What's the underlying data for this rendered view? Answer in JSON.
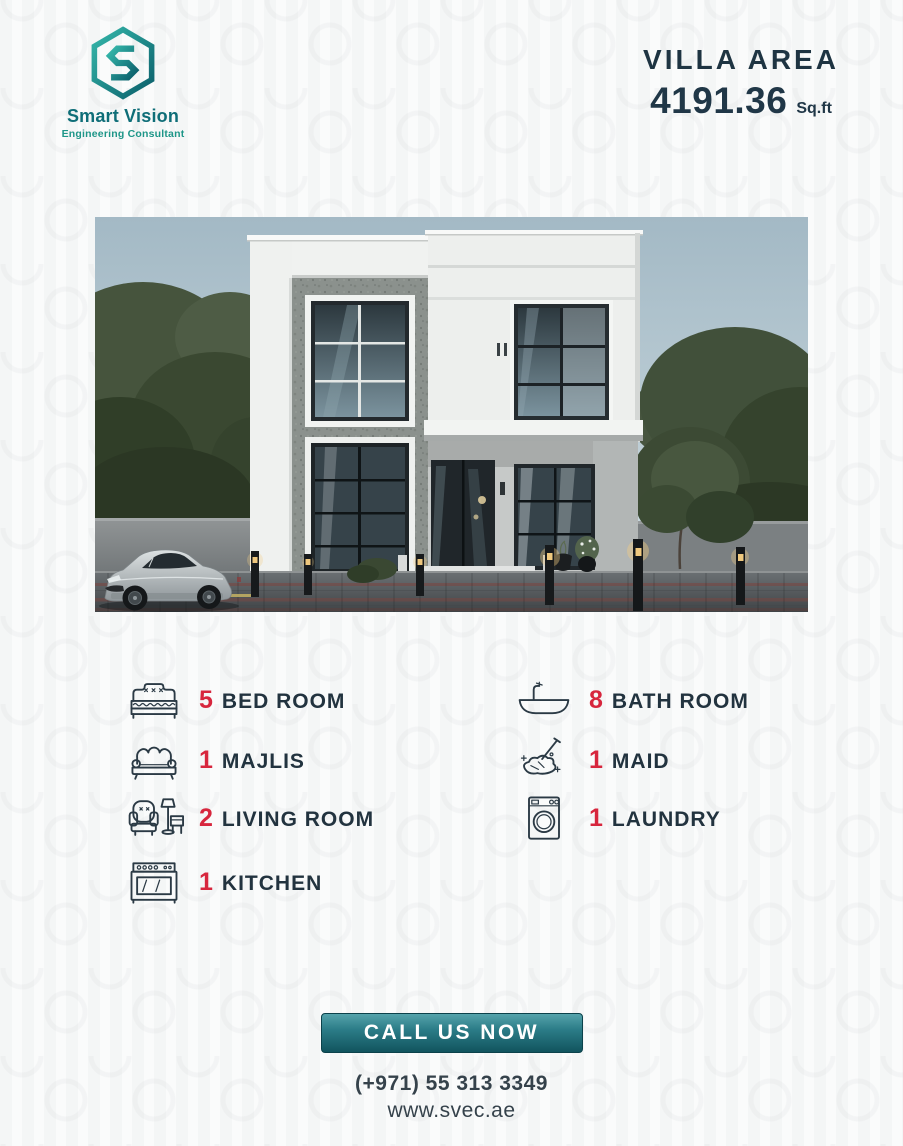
{
  "brand": {
    "name": "Smart Vision",
    "tagline": "Engineering Consultant"
  },
  "area": {
    "label": "VILLA AREA",
    "value": "4191.36",
    "unit": "Sq.ft"
  },
  "features": {
    "left": [
      {
        "count": "5",
        "label": "BED ROOM",
        "icon": "bed-icon"
      },
      {
        "count": "1",
        "label": "MAJLIS",
        "icon": "sofa-icon"
      },
      {
        "count": "2",
        "label": "LIVING ROOM",
        "icon": "armchair-lamp-icon"
      },
      {
        "count": "1",
        "label": "KITCHEN",
        "icon": "stove-icon"
      }
    ],
    "right": [
      {
        "count": "8",
        "label": "BATH ROOM",
        "icon": "bathtub-icon"
      },
      {
        "count": "1",
        "label": "MAID",
        "icon": "mop-icon"
      },
      {
        "count": "1",
        "label": "LAUNDRY",
        "icon": "washing-machine-icon"
      }
    ]
  },
  "cta": {
    "label": "CALL US NOW"
  },
  "contact": {
    "phone": "(+971) 55 313 3349",
    "website": "www.svec.ae"
  },
  "colors": {
    "accent_red": "#d7263d",
    "navy": "#22333f",
    "teal": "#0f6e78",
    "teal_light": "#1d9688",
    "button_gradient_top": "#55a3ab",
    "button_gradient_bottom": "#11545e"
  }
}
